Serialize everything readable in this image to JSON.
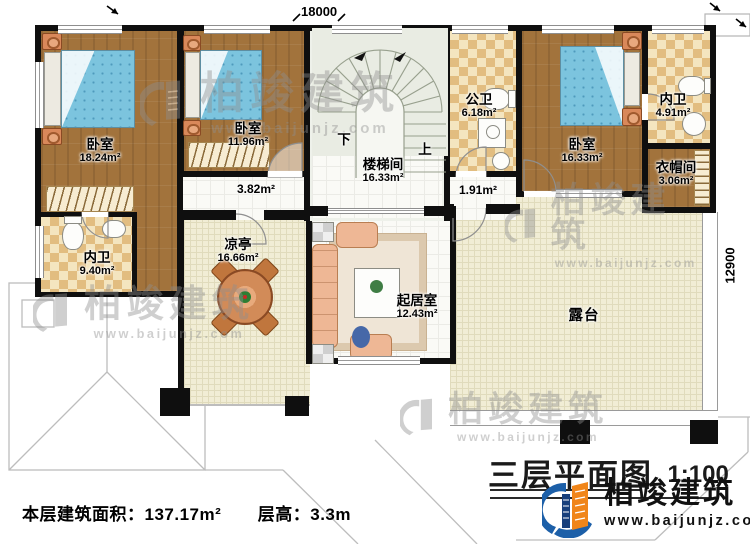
{
  "dimensions": {
    "top": "18000",
    "right": "12900"
  },
  "rooms": [
    {
      "name": "卧室",
      "area": "18.24m²"
    },
    {
      "name": "卧室",
      "area": "11.96m²"
    },
    {
      "name": "楼梯间",
      "area": "16.33m²"
    },
    {
      "name": "公卫",
      "area": "6.18m²"
    },
    {
      "name": "卧室",
      "area": "16.33m²"
    },
    {
      "name": "内卫",
      "area": "4.91m²"
    },
    {
      "name": "衣帽间",
      "area": "3.06m²"
    },
    {
      "name": "内卫",
      "area": "9.40m²"
    },
    {
      "name": "凉亭",
      "area": "16.66m²"
    },
    {
      "name": "起居室",
      "area": "12.43m²"
    },
    {
      "name": "露台",
      "area": ""
    },
    {
      "name": "",
      "area": "3.82m²"
    },
    {
      "name": "",
      "area": "1.91m²"
    }
  ],
  "stairs": {
    "down_label": "下",
    "up_label": "上"
  },
  "title_block": {
    "title": "三层平面图",
    "scale": "1:100"
  },
  "footer": {
    "area_label": "本层建筑面积：",
    "area_value": "137.17m²",
    "height_label": "层高：",
    "height_value": "3.3m"
  },
  "branding": {
    "name": "柏竣建筑",
    "website": "www.baijunjz.com",
    "logo_blue": "#1c5fa8",
    "logo_orange": "#f08519"
  },
  "watermark": {
    "name": "柏竣建筑",
    "website": "www.baijunjz.com"
  }
}
